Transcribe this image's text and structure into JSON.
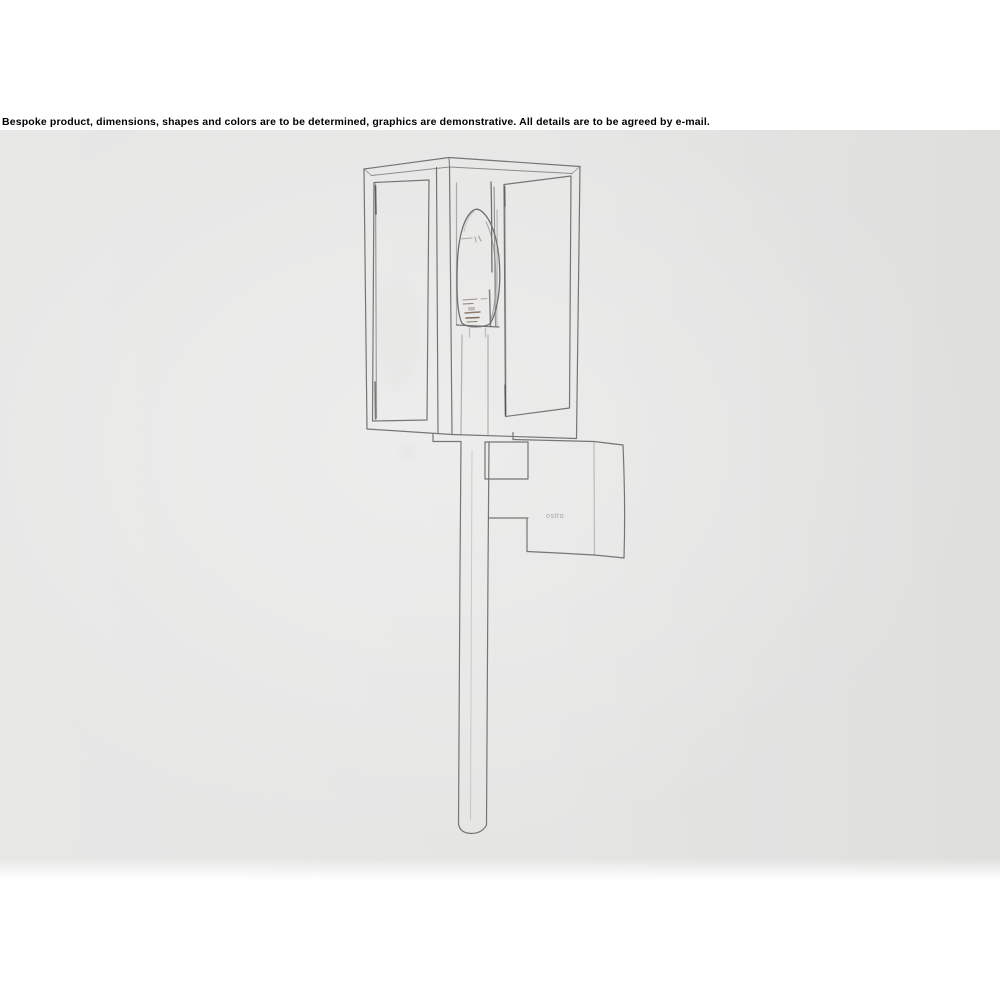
{
  "page": {
    "background": "#ffffff"
  },
  "disclaimer": "Bespoke product, dimensions, shapes and colors are to be determined, graphics are demonstrative. All details are to be agreed by e-mail.",
  "drawing": {
    "subject": "pencil sketch of a bespoke outdoor wall lantern: rectangular glass-box lantern with candle bulb, wall mounting bracket and long downward stem",
    "bracket_label": "ostro",
    "paper_color": "#f7f7f6",
    "line_color": "#757575",
    "dark_line_color": "#424242",
    "bulb_mark_color": "#8b7d6e",
    "label_color": "#a6a3a0"
  }
}
